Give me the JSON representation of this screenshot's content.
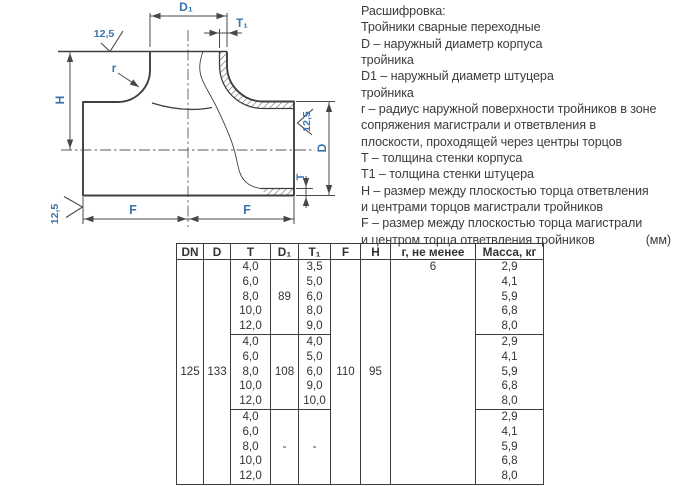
{
  "drawing": {
    "labels": {
      "d1": "D₁",
      "t1": "T₁",
      "r": "r",
      "h": "H",
      "d": "D",
      "t": "T",
      "f_left": "F",
      "f_right": "F",
      "roughness_top": "12,5",
      "roughness_right": "12,5",
      "roughness_bottom": "12,5"
    },
    "accent_color": "#3a74ad",
    "line_color": "#3f3f3f"
  },
  "legend": {
    "title": "Расшифровка:",
    "lines": [
      "Тройники сварные переходные",
      "D – наружный диаметр корпуса",
      "тройника",
      "D1 – наружный диаметр штуцера",
      "тройника",
      "r – радиус наружной поверхности тройников в зоне",
      "сопряжения магистрали и ответвления в",
      "плоскости, проходящей через центры торцов",
      "T – толщина стенки корпуса",
      "T1 – толщина стенки штуцера",
      "H – размер между плоскостью торца ответвления",
      "и центрами торцов магистрали тройников",
      "F – размер между плоскостью торца магистрали"
    ],
    "last_line": "и центром торца ответвления тройников",
    "units": "(мм)"
  },
  "table": {
    "headers": [
      "DN",
      "D",
      "T",
      "D₁",
      "T₁",
      "F",
      "H",
      "г, не менее",
      "Масса, кг"
    ],
    "dn": "125",
    "d": "133",
    "f": "110",
    "h": "95",
    "r_min": "6",
    "blocks": [
      {
        "t": [
          "4,0",
          "6,0",
          "8,0",
          "10,0",
          "12,0"
        ],
        "d1": "89",
        "t1": [
          "3,5",
          "5,0",
          "6,0",
          "8,0",
          "9,0"
        ],
        "mass": [
          "2,9",
          "4,1",
          "5,9",
          "6,8",
          "8,0"
        ]
      },
      {
        "t": [
          "4,0",
          "6,0",
          "8,0",
          "10,0",
          "12,0"
        ],
        "d1": "108",
        "t1": [
          "4,0",
          "5,0",
          "6,0",
          "9,0",
          "10,0"
        ],
        "mass": [
          "2,9",
          "4,1",
          "5,9",
          "6,8",
          "8,0"
        ]
      },
      {
        "t": [
          "4,0",
          "6,0",
          "8,0",
          "10,0",
          "12,0"
        ],
        "d1": "-",
        "t1": "-",
        "mass": [
          "2,9",
          "4,1",
          "5,9",
          "6,8",
          "8,0"
        ]
      }
    ]
  }
}
